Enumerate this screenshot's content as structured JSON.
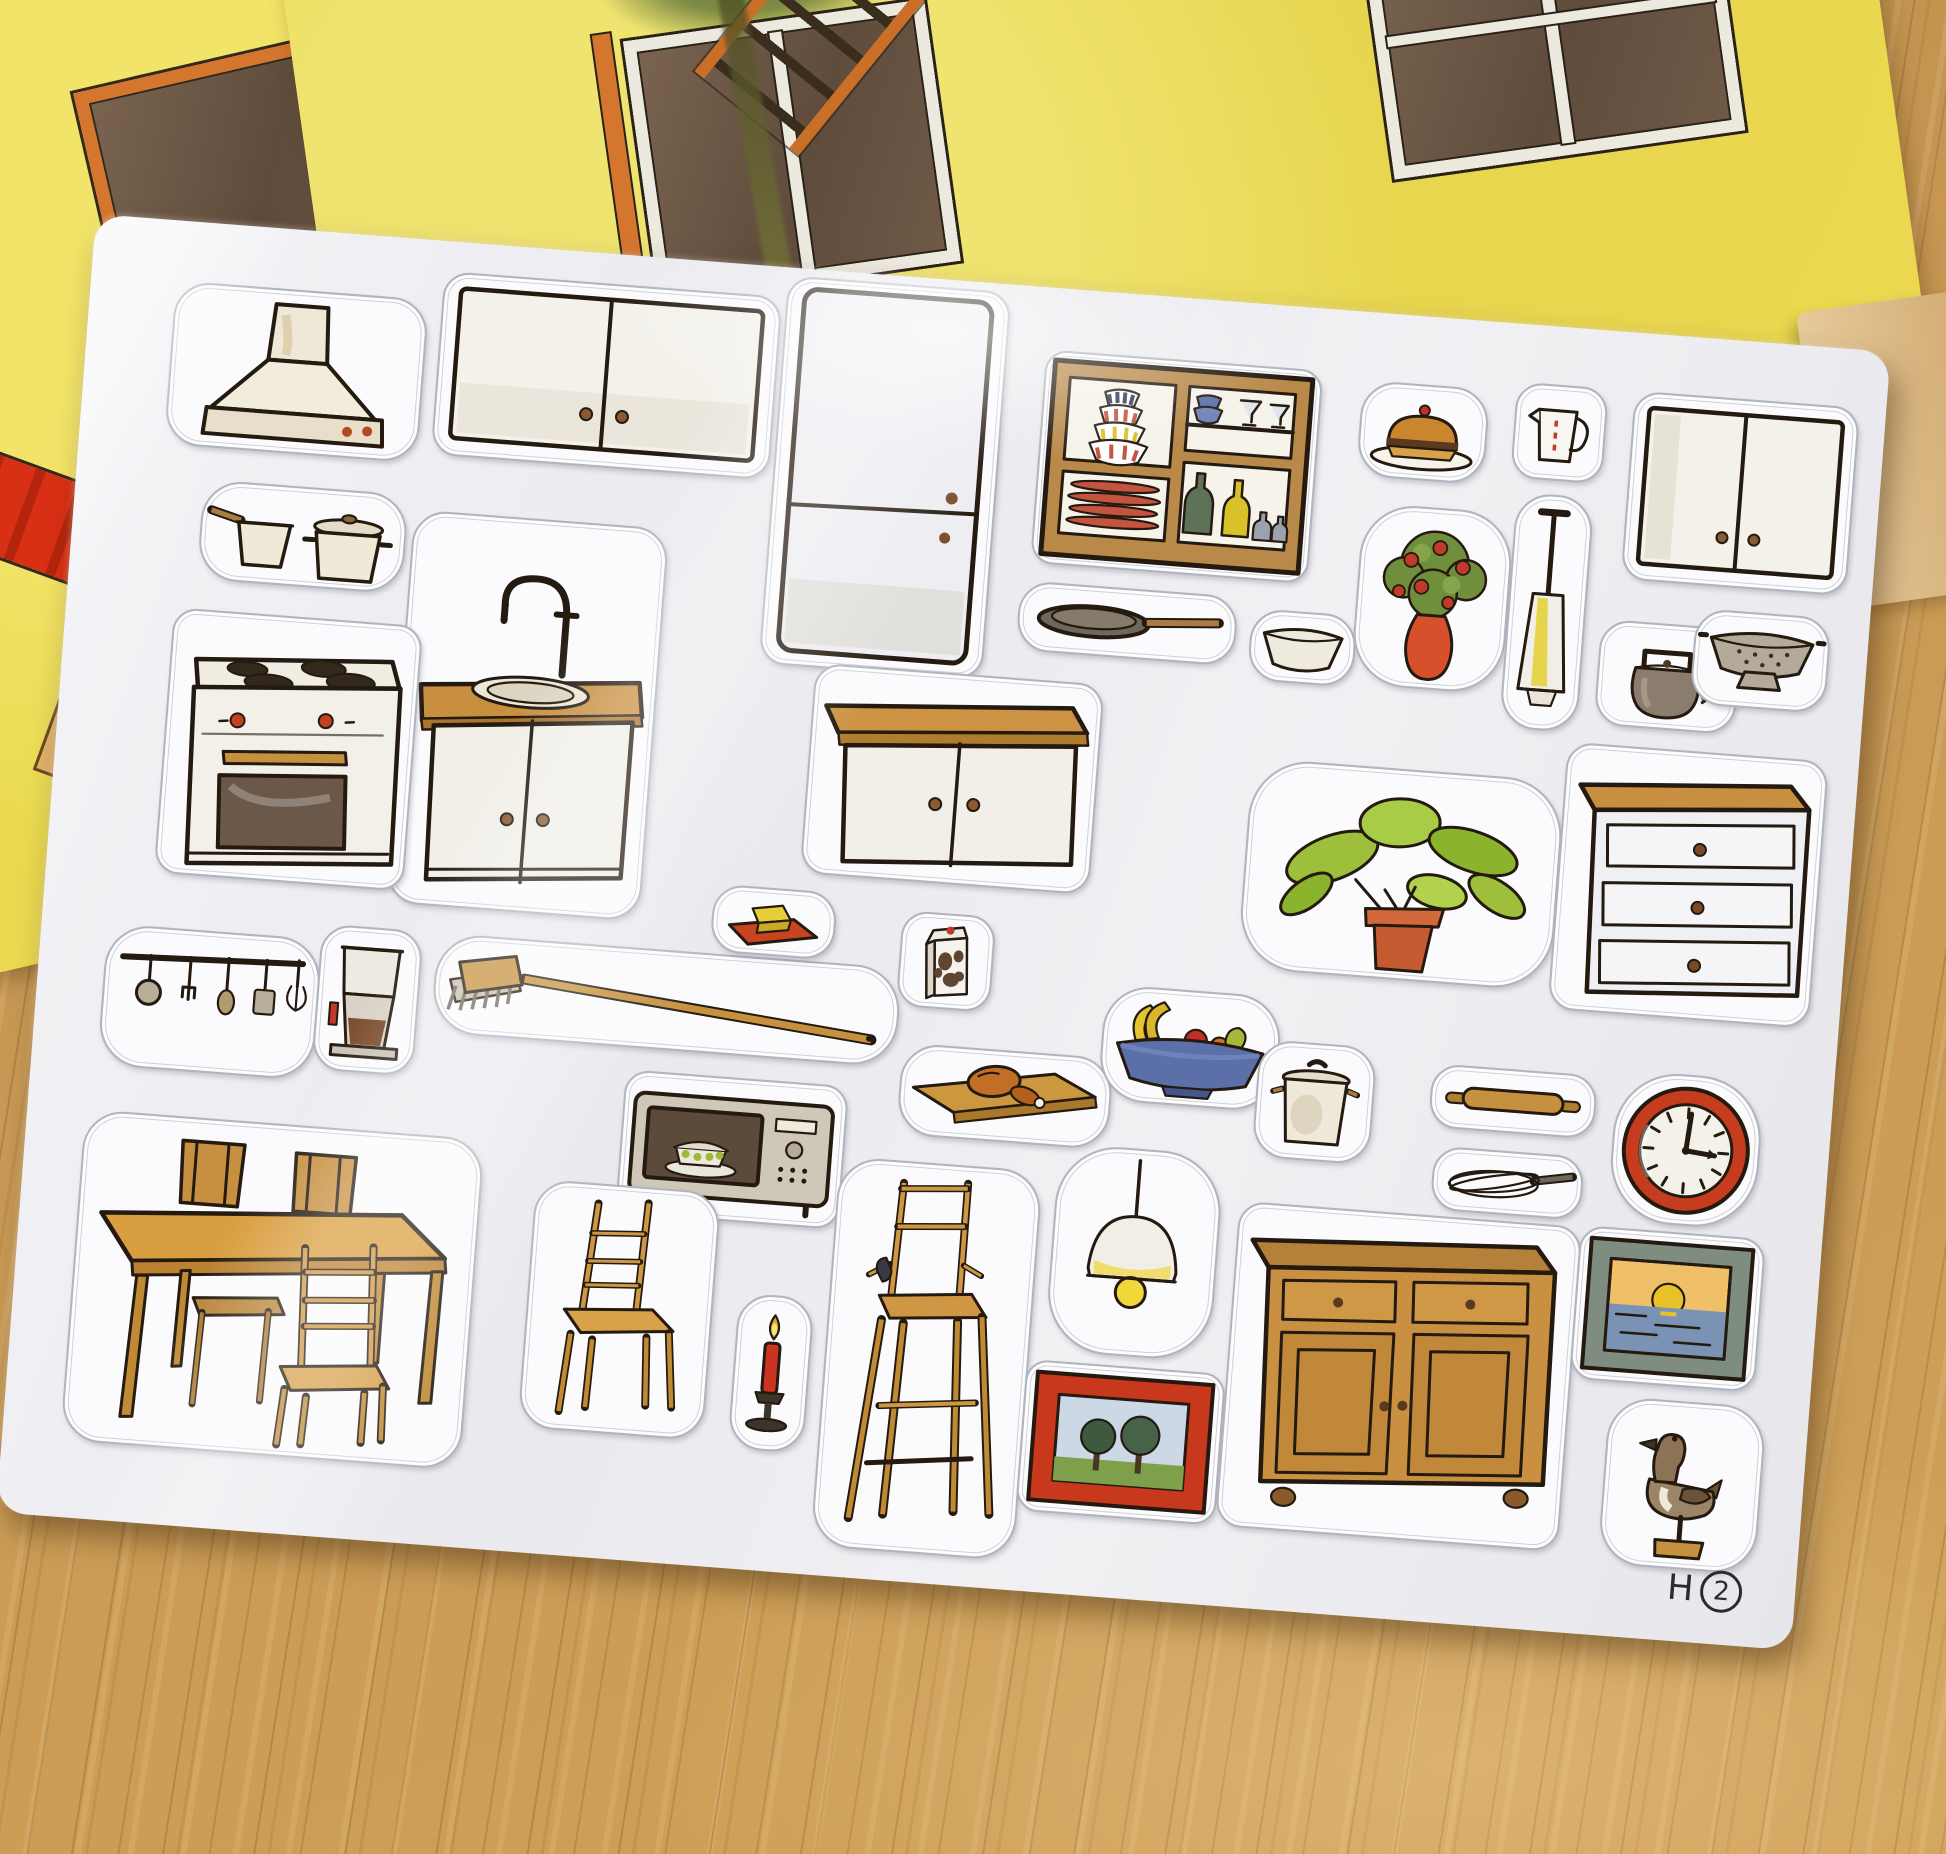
{
  "scene": {
    "subject": "kitchen furniture sticker sheet photographed on a wooden table",
    "background_items": [
      "illustrated storybook pages with yellow house, orange-framed windows, red roofs, ladder and foliage",
      "light oak wooden table surface"
    ]
  },
  "sheet": {
    "code_letter": "H",
    "code_number": "2",
    "stickers": [
      {
        "id": "range-hood",
        "label": "range hood"
      },
      {
        "id": "wall-cabinet-left",
        "label": "two-door wall cabinet"
      },
      {
        "id": "refrigerator",
        "label": "refrigerator"
      },
      {
        "id": "dish-shelf",
        "label": "shelf with bowls, plates, glasses and bottles"
      },
      {
        "id": "cake-plate",
        "label": "cake on plate"
      },
      {
        "id": "measuring-jug",
        "label": "measuring jug"
      },
      {
        "id": "wall-cabinet-right",
        "label": "two-door wall cabinet"
      },
      {
        "id": "cooking-pots",
        "label": "saucepan and pot"
      },
      {
        "id": "sink-cabinet",
        "label": "sink cabinet with faucet"
      },
      {
        "id": "frying-pan",
        "label": "frying pan"
      },
      {
        "id": "mixing-bowl",
        "label": "mixing bowl"
      },
      {
        "id": "flower-vase",
        "label": "flowers in red vase"
      },
      {
        "id": "hand-blender",
        "label": "hand blender"
      },
      {
        "id": "kettle",
        "label": "kettle"
      },
      {
        "id": "colander",
        "label": "colander"
      },
      {
        "id": "stove",
        "label": "stove with oven"
      },
      {
        "id": "base-cabinet",
        "label": "base cabinet with wooden top"
      },
      {
        "id": "potted-plant",
        "label": "potted green plant"
      },
      {
        "id": "drawer-dresser",
        "label": "three-drawer dresser"
      },
      {
        "id": "utensil-rail",
        "label": "hanging utensil rail"
      },
      {
        "id": "coffee-maker",
        "label": "coffee maker"
      },
      {
        "id": "broom",
        "label": "broom"
      },
      {
        "id": "butter-dish",
        "label": "butter on red dish"
      },
      {
        "id": "milk-carton",
        "label": "milk carton"
      },
      {
        "id": "microwave",
        "label": "microwave with casserole"
      },
      {
        "id": "roast-on-board",
        "label": "roast chicken on cutting board"
      },
      {
        "id": "fruit-bowl",
        "label": "fruit bowl"
      },
      {
        "id": "stock-pot",
        "label": "stock pot with lid"
      },
      {
        "id": "rolling-pin",
        "label": "rolling pin"
      },
      {
        "id": "whisk",
        "label": "whisk"
      },
      {
        "id": "wall-clock",
        "label": "red wall clock"
      },
      {
        "id": "dining-table",
        "label": "dining table with chairs"
      },
      {
        "id": "chair",
        "label": "wooden chair"
      },
      {
        "id": "candle",
        "label": "red candle on candlestick"
      },
      {
        "id": "high-chair",
        "label": "child high chair"
      },
      {
        "id": "pendant-lamp",
        "label": "pendant lamp"
      },
      {
        "id": "picture-trees",
        "label": "framed picture of trees"
      },
      {
        "id": "sideboard",
        "label": "wooden sideboard"
      },
      {
        "id": "picture-sunset",
        "label": "framed sunset picture"
      },
      {
        "id": "duck-figurine",
        "label": "duck figurine on stand"
      }
    ]
  },
  "colors": {
    "sheet_white": "#f1f1f4",
    "ink": "#241a10",
    "wood_table": "#c99a55",
    "book_yellow": "#e9d952",
    "roof_red": "#d83015",
    "furniture_wood": "#c98f41",
    "accent_red": "#c63c1e",
    "plant_green": "#9ebf3b",
    "bowl_blue": "#5b6fa8"
  }
}
